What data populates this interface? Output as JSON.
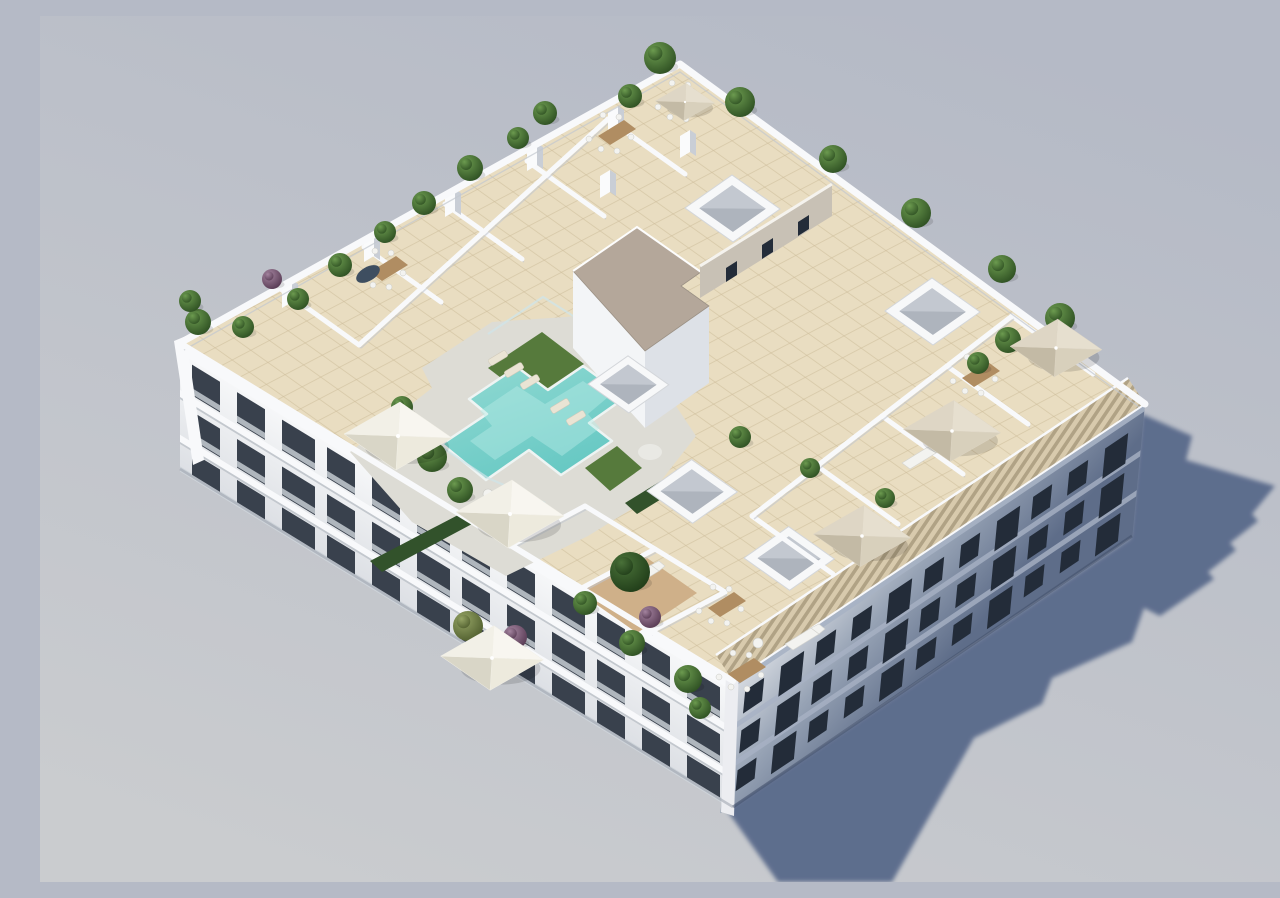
{
  "meta": {
    "title": "Aerial 3D architectural render of a white apartment building with rooftop pool terrace",
    "view": "high-angle isometric aerial render, daylight, no visible text or UI",
    "shadow_direction": "lower-right"
  },
  "colors": {
    "bg_top": "#b5bac6",
    "bg_bottom": "#cacccf",
    "shadow": "#566889",
    "facade_top": "#f8f9fa",
    "facade_bottom": "#dcdfe4",
    "shade_a": "#d9dde3",
    "shade_b": "#97a3b5",
    "shade_c": "#5e6d89",
    "window_dark": "#39414d",
    "window_shade": "#232c39",
    "railing": "#cdd3d9",
    "cornice_shadow": "#c3c8ce",
    "cornice_shade": "#a7b2c4",
    "parapet": "#f8f9fb",
    "tile": "#e9ddc1",
    "tile_line": "#cbbb98",
    "deck": "#dddcd5",
    "pool_a": "#92dad3",
    "pool_b": "#66c8c3",
    "pool_light": "#b9ece6",
    "pool_coping": "#eef4f3",
    "glass": "#cfe4e8",
    "grass": "#567a3c",
    "hedge": "#32522b",
    "gravel": "#b4a79a",
    "core_wall": "#c8c1b5",
    "pergola": "#d8caad",
    "pergola_stripe": "#a6987b",
    "sky_inner": "#ccd1d8",
    "sky_mid": "#c3c8d0",
    "sky_deep": "#aeb4bd",
    "wood": "#b08d62",
    "wood_deck": "#cfb089",
    "furniture": "#f3f3f0",
    "plant": "#41702f",
    "plant_dark": "#2c5123",
    "plant_purple": "#7b5a78",
    "plant_olive": "#6d7c46",
    "umb_white": "#f2f0e8",
    "umb_beige": "#d9d0bd",
    "edge_shade": "#c2c7cf",
    "base_line": "#9aa0ab",
    "base_shade": "#3e4c66",
    "table_dark": "#3e4e60",
    "corner_strip": "#ecedf1"
  },
  "umbrella_palette": {
    "white": [
      "#f8f6f0",
      "#edeadd",
      "#d9d6c7",
      "#f2f0e7"
    ],
    "beige": [
      "#e6dfcf",
      "#d8d0bc",
      "#c3baa5",
      "#ded6c5"
    ]
  },
  "scene": {
    "building": {
      "storeys_visible": 4,
      "left_facade_window_rows": 3,
      "left_facade_window_cols": 12,
      "right_facade_window_rows": 3,
      "right_facade_window_cols": 11
    },
    "plants": [
      [
        620,
        42,
        16,
        "g"
      ],
      [
        590,
        80,
        12,
        "g"
      ],
      [
        505,
        97,
        12,
        "g"
      ],
      [
        478,
        122,
        11,
        "g"
      ],
      [
        430,
        152,
        13,
        "g"
      ],
      [
        384,
        187,
        12,
        "g"
      ],
      [
        345,
        216,
        11,
        "g"
      ],
      [
        300,
        249,
        12,
        "g"
      ],
      [
        258,
        283,
        11,
        "g"
      ],
      [
        232,
        263,
        10,
        "p"
      ],
      [
        203,
        311,
        11,
        "g"
      ],
      [
        158,
        306,
        13,
        "g"
      ],
      [
        150,
        285,
        11,
        "g"
      ],
      [
        700,
        86,
        15,
        "g"
      ],
      [
        793,
        143,
        14,
        "g"
      ],
      [
        876,
        197,
        15,
        "g"
      ],
      [
        962,
        253,
        14,
        "g"
      ],
      [
        1020,
        302,
        15,
        "g"
      ],
      [
        968,
        324,
        13,
        "g"
      ],
      [
        938,
        347,
        11,
        "g"
      ],
      [
        392,
        441,
        15,
        "g"
      ],
      [
        420,
        474,
        13,
        "g"
      ],
      [
        362,
        391,
        11,
        "g"
      ],
      [
        545,
        587,
        12,
        "g"
      ],
      [
        592,
        627,
        13,
        "g"
      ],
      [
        648,
        663,
        14,
        "g"
      ],
      [
        610,
        601,
        11,
        "p"
      ],
      [
        660,
        692,
        11,
        "g"
      ],
      [
        475,
        621,
        12,
        "p"
      ],
      [
        428,
        610,
        15,
        "o"
      ],
      [
        590,
        556,
        20,
        "d"
      ],
      [
        700,
        421,
        11,
        "g"
      ],
      [
        770,
        452,
        10,
        "g"
      ],
      [
        845,
        482,
        10,
        "g"
      ]
    ],
    "umbrellas": [
      [
        358,
        420,
        "white",
        1
      ],
      [
        470,
        498,
        "white",
        1
      ],
      [
        452,
        642,
        "white",
        0.95
      ],
      [
        822,
        520,
        "beige",
        0.9
      ],
      [
        912,
        415,
        "beige",
        0.9
      ],
      [
        1016,
        332,
        "beige",
        0.85
      ],
      [
        645,
        86,
        "beige",
        0.55
      ]
    ],
    "skylights": [
      [
        645,
        192,
        1
      ],
      [
        845,
        295,
        1
      ],
      [
        548,
        368,
        0.85
      ],
      [
        607,
        475,
        0.95
      ],
      [
        704,
        542,
        0.95
      ]
    ],
    "partitions": [
      [
        568,
        103,
        645,
        158
      ],
      [
        487,
        145,
        564,
        200
      ],
      [
        405,
        188,
        482,
        243
      ],
      [
        324,
        231,
        401,
        286
      ],
      [
        242,
        274,
        319,
        329
      ],
      [
        319,
        329,
        568,
        103
      ],
      [
        712,
        500,
        793,
        558
      ],
      [
        777,
        450,
        858,
        508
      ],
      [
        842,
        400,
        923,
        458
      ],
      [
        907,
        350,
        988,
        408
      ],
      [
        972,
        300,
        1053,
        358
      ],
      [
        712,
        500,
        972,
        300
      ],
      [
        470,
        530,
        545,
        490
      ],
      [
        540,
        573,
        615,
        533
      ],
      [
        610,
        616,
        685,
        576
      ],
      [
        545,
        490,
        685,
        576
      ]
    ],
    "pillars": [
      [
        568,
        96
      ],
      [
        487,
        133
      ],
      [
        405,
        179
      ],
      [
        324,
        224
      ],
      [
        242,
        270
      ],
      [
        560,
        160
      ],
      [
        640,
        120
      ]
    ],
    "dining_sets": [
      [
        330,
        256
      ],
      [
        627,
        88
      ],
      [
        922,
        362
      ],
      [
        668,
        592
      ],
      [
        688,
        658
      ],
      [
        558,
        120
      ]
    ],
    "sofas": [
      [
        745,
        628
      ],
      [
        862,
        447
      ],
      [
        585,
        565
      ]
    ],
    "loungers": [
      [
        458,
        342
      ],
      [
        474,
        354
      ],
      [
        490,
        366
      ],
      [
        520,
        390
      ],
      [
        536,
        402
      ]
    ],
    "round_tables": [
      [
        718,
        627
      ],
      [
        448,
        478
      ]
    ],
    "oval_table": [
      328,
      258
    ]
  }
}
